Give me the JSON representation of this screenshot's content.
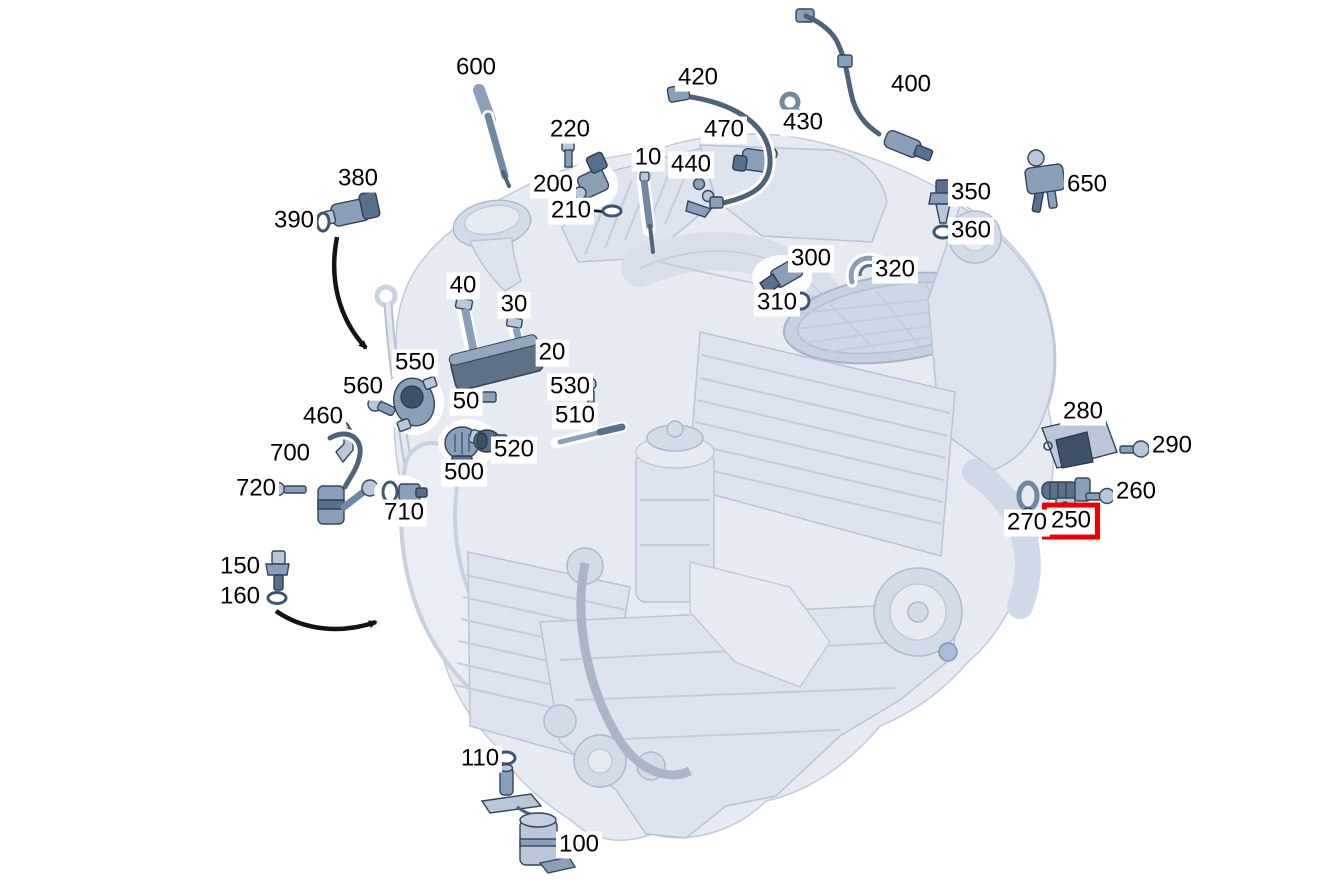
{
  "diagram": {
    "subject": "engine-sensors-exploded-parts-diagram",
    "colors": {
      "background": "#ffffff",
      "label_text": "#000000",
      "highlight_box": "#ee0000",
      "engine_fill": "#e4eaf2",
      "engine_line": "#c0cad9",
      "part_fill": "#8aa0b8",
      "part_dark": "#3f5166"
    },
    "selected_callout": "250",
    "callouts": [
      {
        "label": "600",
        "x": 476,
        "y": 68
      },
      {
        "label": "420",
        "x": 698,
        "y": 78
      },
      {
        "label": "400",
        "x": 911,
        "y": 85
      },
      {
        "label": "430",
        "x": 803,
        "y": 123
      },
      {
        "label": "220",
        "x": 570,
        "y": 130
      },
      {
        "label": "470",
        "x": 724,
        "y": 130
      },
      {
        "label": "10",
        "x": 648,
        "y": 158
      },
      {
        "label": "440",
        "x": 691,
        "y": 165
      },
      {
        "label": "380",
        "x": 358,
        "y": 179
      },
      {
        "label": "650",
        "x": 1087,
        "y": 185
      },
      {
        "label": "200",
        "x": 553,
        "y": 185
      },
      {
        "label": "350",
        "x": 971,
        "y": 193
      },
      {
        "label": "210",
        "x": 571,
        "y": 211
      },
      {
        "label": "390",
        "x": 294,
        "y": 221
      },
      {
        "label": "360",
        "x": 971,
        "y": 231
      },
      {
        "label": "300",
        "x": 811,
        "y": 259
      },
      {
        "label": "320",
        "x": 895,
        "y": 270
      },
      {
        "label": "40",
        "x": 463,
        "y": 286
      },
      {
        "label": "310",
        "x": 777,
        "y": 303
      },
      {
        "label": "30",
        "x": 514,
        "y": 305
      },
      {
        "label": "20",
        "x": 552,
        "y": 353
      },
      {
        "label": "550",
        "x": 415,
        "y": 363
      },
      {
        "label": "530",
        "x": 570,
        "y": 387
      },
      {
        "label": "560",
        "x": 363,
        "y": 387
      },
      {
        "label": "50",
        "x": 466,
        "y": 402
      },
      {
        "label": "280",
        "x": 1083,
        "y": 412
      },
      {
        "label": "510",
        "x": 575,
        "y": 416
      },
      {
        "label": "460",
        "x": 323,
        "y": 417
      },
      {
        "label": "290",
        "x": 1172,
        "y": 446
      },
      {
        "label": "520",
        "x": 514,
        "y": 450
      },
      {
        "label": "700",
        "x": 290,
        "y": 454
      },
      {
        "label": "500",
        "x": 464,
        "y": 473
      },
      {
        "label": "720",
        "x": 256,
        "y": 489
      },
      {
        "label": "260",
        "x": 1136,
        "y": 492
      },
      {
        "label": "710",
        "x": 404,
        "y": 513
      },
      {
        "label": "250",
        "x": 1071,
        "y": 521,
        "highlighted": true
      },
      {
        "label": "270",
        "x": 1027,
        "y": 523
      },
      {
        "label": "150",
        "x": 240,
        "y": 567
      },
      {
        "label": "160",
        "x": 240,
        "y": 597
      },
      {
        "label": "110",
        "x": 480,
        "y": 759
      },
      {
        "label": "100",
        "x": 579,
        "y": 845
      }
    ]
  }
}
